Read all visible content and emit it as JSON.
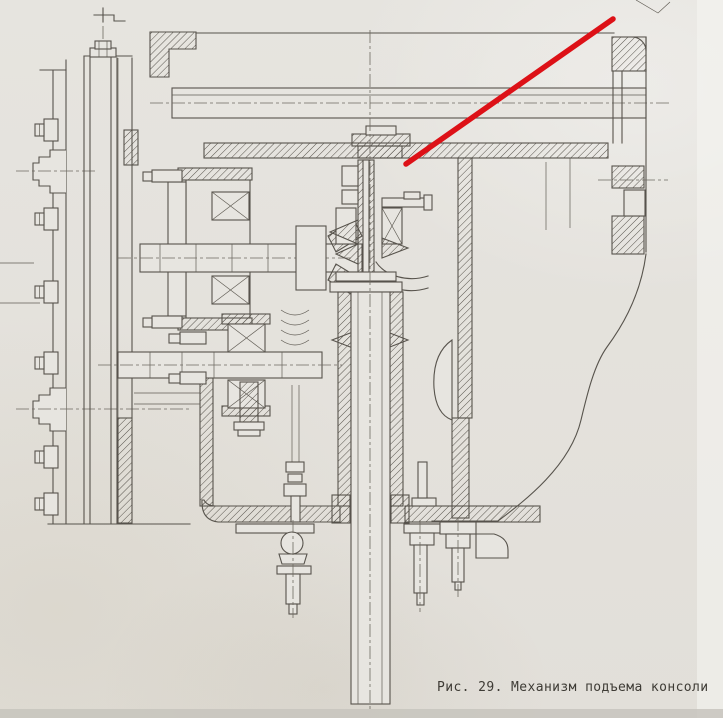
{
  "figure": {
    "caption": "Рис. 29. Механизм подъема консоли",
    "number": "29",
    "title": "Механизм подъема консоли"
  },
  "annotation": {
    "kind": "red-pointer-line",
    "color": "#dd1117",
    "x1": 613,
    "y1": 19,
    "x2": 406,
    "y2": 164,
    "stroke_width": 5.5
  },
  "page": {
    "paper_color": "#e5e3de",
    "ink_color": "#57534c"
  }
}
